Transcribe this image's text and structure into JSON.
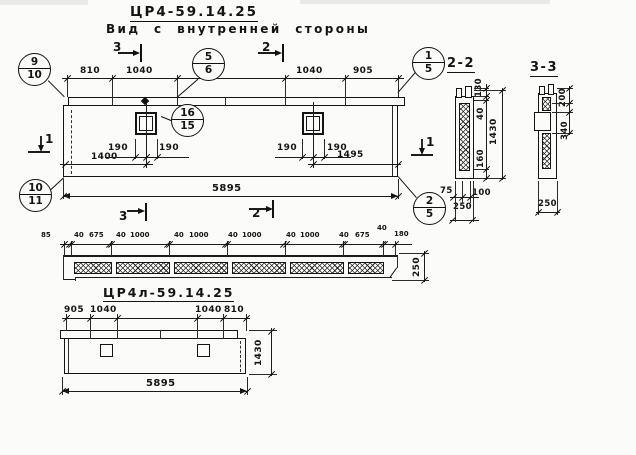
{
  "sheet": {
    "title": "ЦР4-59.14.25",
    "subtitle": "Вид с внутренней стороны",
    "bottom_title": "ЦР4л-59.14.25"
  },
  "sections": {
    "s22": "2-2",
    "s33": "3-3"
  },
  "markers": {
    "top3": "3",
    "top2": "2",
    "bottom3": "3",
    "bottom2": "2",
    "left1": "1",
    "right1": "1"
  },
  "callouts": {
    "c910": {
      "top": "9",
      "bottom": "10"
    },
    "c56": {
      "top": "5",
      "bottom": "6"
    },
    "c1615": {
      "top": "16",
      "bottom": "15"
    },
    "c15": {
      "top": "1",
      "bottom": "5"
    },
    "c25": {
      "top": "2",
      "bottom": "5"
    },
    "c1011": {
      "top": "10",
      "bottom": "11"
    }
  },
  "main_view": {
    "top_dims": [
      "810",
      "1040",
      "1040",
      "905"
    ],
    "opening_dims": [
      "190",
      "190",
      "190",
      "190"
    ],
    "span_left": "1400",
    "span_right": "1495",
    "total": "5895"
  },
  "strip_view": {
    "dims": [
      "85",
      "40",
      "675",
      "40",
      "1000",
      "40",
      "1000",
      "40",
      "1000",
      "40",
      "1000",
      "40",
      "675",
      "40",
      "180"
    ],
    "height": "250"
  },
  "bottom_view": {
    "top_dims": [
      "905",
      "1040",
      "1040",
      "810"
    ],
    "height": "1430",
    "total": "5895"
  },
  "sec22": {
    "d130": "130",
    "d40": "40",
    "d1430": "1430",
    "d160": "160",
    "d75": "75",
    "d100": "100",
    "d250": "250"
  },
  "sec33": {
    "d200": "200",
    "d340": "340",
    "d250": "250"
  }
}
